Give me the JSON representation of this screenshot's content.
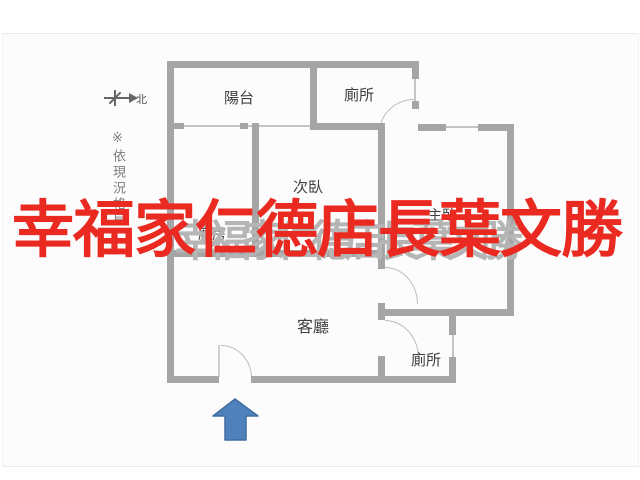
{
  "watermark": {
    "text": "幸福家仁德店長葉文勝",
    "color": "#ea2a20",
    "shadow_text": "幸福家仁德店長葉文勝",
    "shadow_color": "#b5b5b5"
  },
  "annotations": {
    "vertical_note": "※依現況格局",
    "compass_label": "北"
  },
  "rooms": {
    "balcony": "陽台",
    "toilet_top": "廁所",
    "bedroom_secondary": "次臥",
    "bedroom_master": "主臥",
    "kitchen": "廚房",
    "living_room": "客廳",
    "toilet_bottom": "廁所"
  },
  "entrance": {
    "arrow_color": "#4f81bd",
    "arrow_border": "#3f6d9e"
  },
  "plan_colors": {
    "wall": "#a5a5a5",
    "door_arc": "#bdbdbd"
  }
}
